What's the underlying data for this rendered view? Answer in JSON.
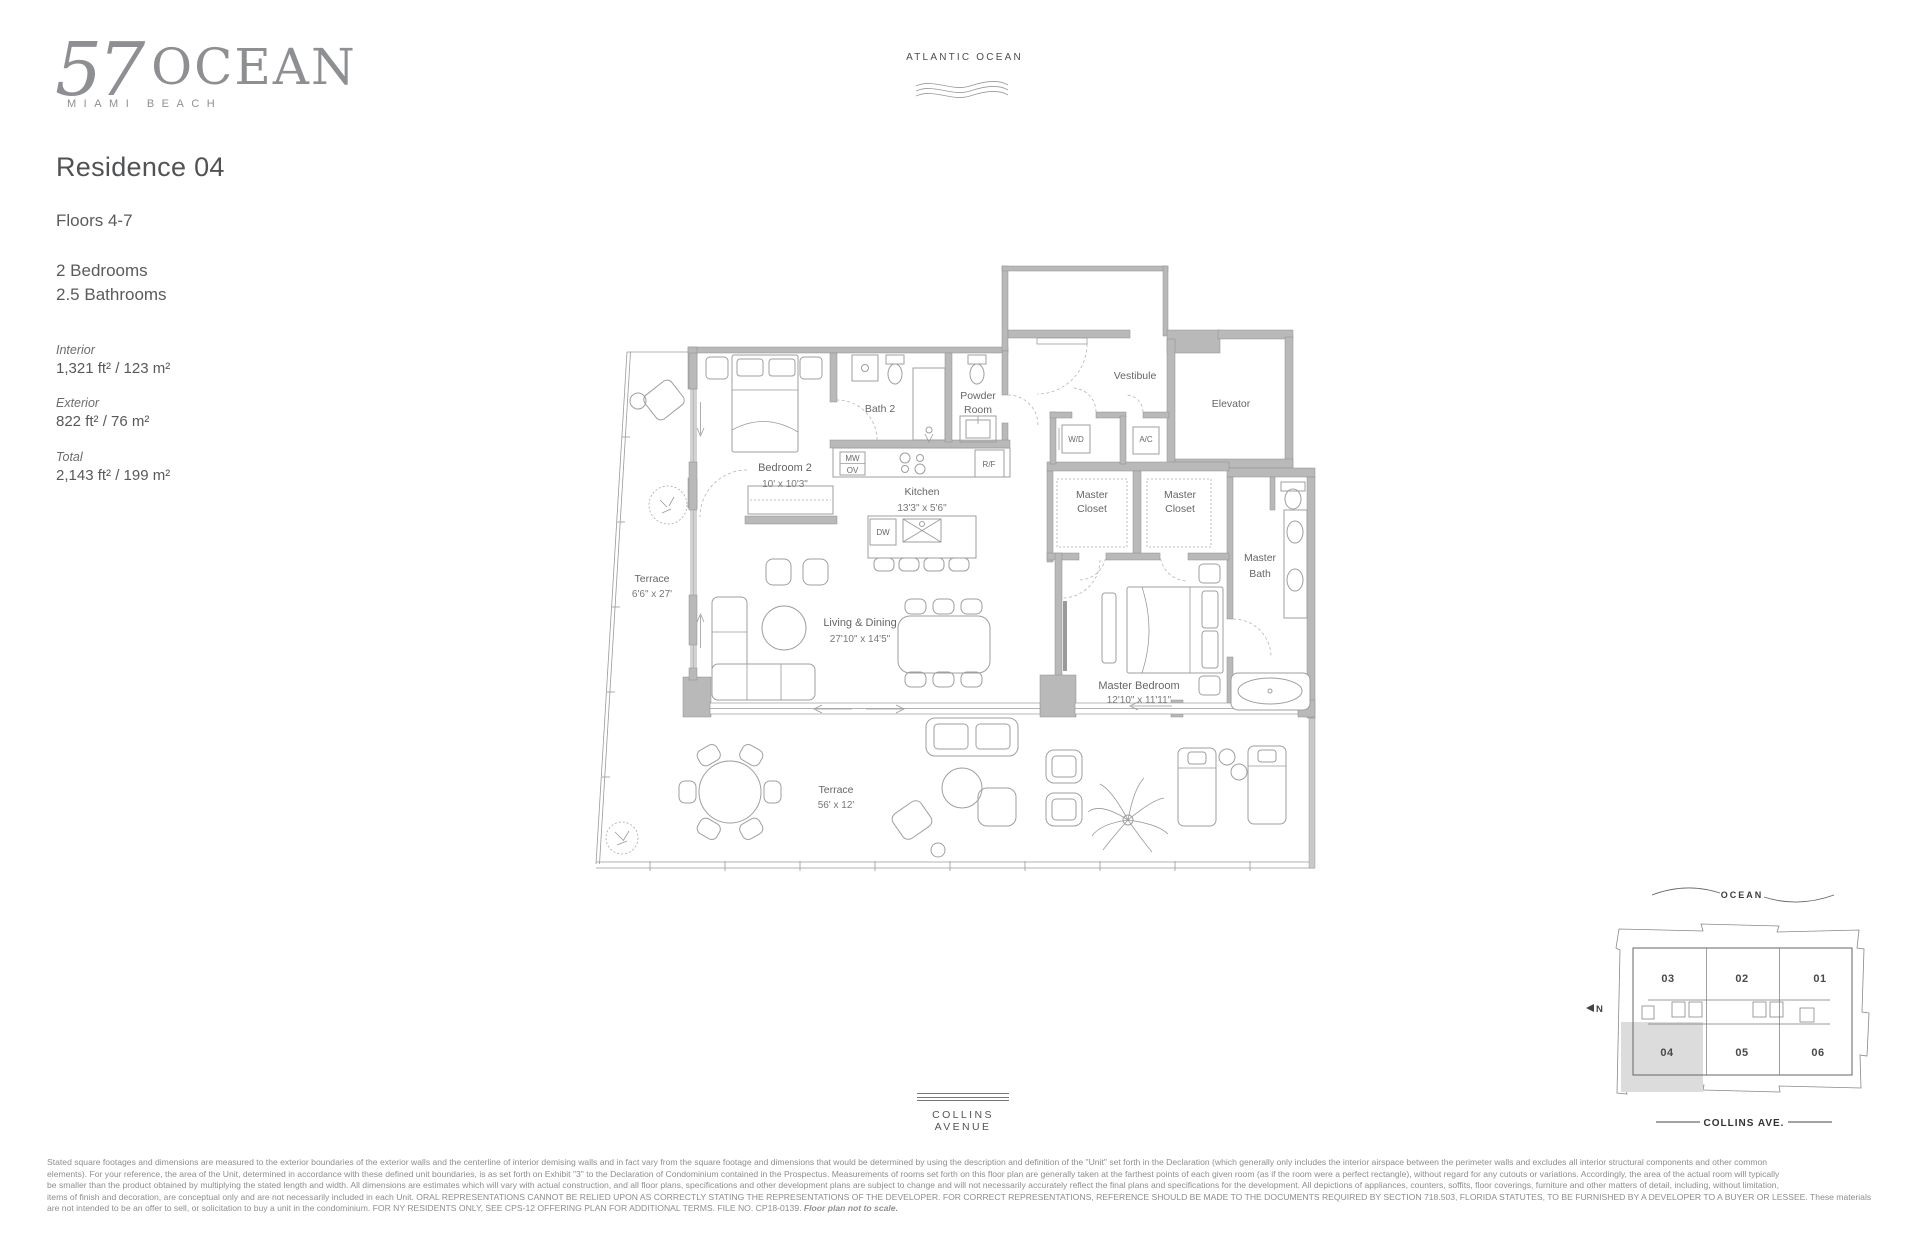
{
  "colors": {
    "wall": "#b9b9b9",
    "line": "#9f9f9f",
    "text": "#58595b",
    "logo": "#8d8f92",
    "shade": "#dcdcdc"
  },
  "logo": {
    "number": "57",
    "name": "OCEAN",
    "tagline": "MIAMI BEACH"
  },
  "info": {
    "residence": "Residence 04",
    "floors": "Floors 4-7",
    "bedrooms": "2 Bedrooms",
    "bathrooms": "2.5 Bathrooms",
    "interior_label": "Interior",
    "interior_value": "1,321 ft² / 123 m²",
    "exterior_label": "Exterior",
    "exterior_value": "822 ft² / 76 m²",
    "total_label": "Total",
    "total_value": "2,143 ft² / 199 m²"
  },
  "orientation": {
    "ocean": "ATLANTIC OCEAN",
    "street": "COLLINS AVENUE"
  },
  "plan_labels": {
    "bedroom2": "Bedroom 2",
    "bedroom2_dims": "10' x 10'3\"",
    "bath2": "Bath 2",
    "powder1": "Powder",
    "powder2": "Room",
    "vestibule": "Vestibule",
    "elevator": "Elevator",
    "wd": "W/D",
    "ac": "A/C",
    "mw": "MW",
    "ov": "OV",
    "rf": "R/F",
    "dw": "DW",
    "kitchen": "Kitchen",
    "kitchen_dims": "13'3\" x 5'6\"",
    "living": "Living & Dining",
    "living_dims": "27'10\" x 14'5\"",
    "master": "Master Bedroom",
    "master_dims": "12'10\" x 11'11\"",
    "mcloset1a": "Master",
    "mcloset1b": "Closet",
    "mcloset2a": "Master",
    "mcloset2b": "Closet",
    "mbath1": "Master",
    "mbath2": "Bath",
    "terrace_side": "Terrace",
    "terrace_side_dims": "6'6\" x 27'",
    "terrace_main": "Terrace",
    "terrace_main_dims": "56' x 12'"
  },
  "keyplan": {
    "ocean": "OCEAN",
    "street": "COLLINS AVE.",
    "north": "N",
    "highlighted_unit": "04",
    "units": {
      "u01": "01",
      "u02": "02",
      "u03": "03",
      "u04": "04",
      "u05": "05",
      "u06": "06"
    }
  },
  "disclaimer": {
    "line1": "Stated square footages and dimensions are measured to the exterior boundaries of the exterior walls and the centerline of interior demising walls and in fact vary from the square footage and dimensions that would be determined by using the description and definition of the \"Unit\" set forth in the Declaration (which generally only includes the interior airspace between the perimeter walls and excludes all interior structural components and other common",
    "line2": "elements). For your reference, the area of the Unit, determined in accordance with these defined unit boundaries, is as set forth on Exhibit \"3\" to the Declaration of Condominium contained in the Prospectus. Measurements of rooms set forth on this floor plan are generally taken at the farthest points of each given room (as if the room were a perfect rectangle), without regard for any cutouts or variations. Accordingly, the area of the actual room will typically",
    "line3": "be smaller than the product obtained by multiplying the stated length and width. All dimensions are estimates which will vary with actual construction, and all floor plans, specifications and other development plans are subject to change and will not necessarily accurately reflect the final plans and specifications for the development. All depictions of appliances, counters, soffits, floor coverings, furniture and other matters of detail, including, without limitation,",
    "line4": "items of finish and decoration, are conceptual only and are not necessarily included in each Unit. ORAL REPRESENTATIONS CANNOT BE RELIED UPON AS CORRECTLY STATING THE REPRESENTATIONS OF THE DEVELOPER. FOR CORRECT REPRESENTATIONS, REFERENCE SHOULD BE MADE TO THE DOCUMENTS REQUIRED BY SECTION 718.503, FLORIDA STATUTES, TO BE FURNISHED BY A DEVELOPER TO A BUYER OR LESSEE. These materials",
    "line5": "are not intended to be an offer to sell, or solicitation to buy a unit in the condominium. FOR NY RESIDENTS ONLY, SEE CPS-12 OFFERING PLAN FOR ADDITIONAL TERMS. FILE NO. CP18-0139. ",
    "line5_note": "Floor plan not to scale."
  }
}
